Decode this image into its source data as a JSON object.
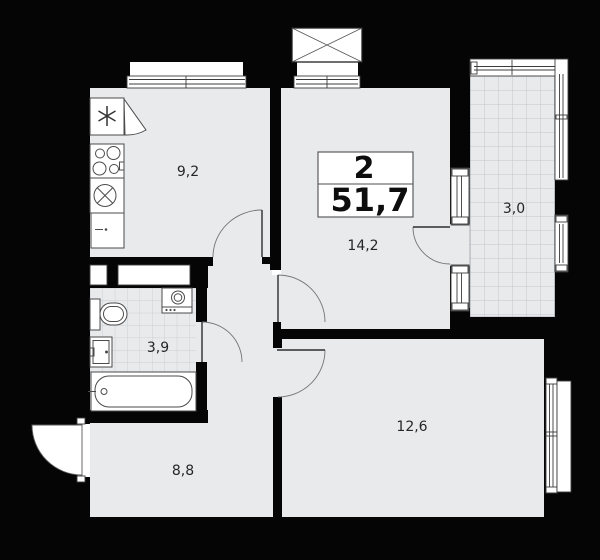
{
  "plan": {
    "type": "apartment-floor-plan",
    "summary": {
      "rooms": "2",
      "total_area": "51,7"
    },
    "rooms": {
      "kitchen": {
        "label": "9,2"
      },
      "living_room": {
        "label": "14,2"
      },
      "balcony": {
        "label": "3,0"
      },
      "bathroom": {
        "label": "3,9"
      },
      "hallway": {
        "label": "8,8"
      },
      "bedroom": {
        "label": "12,6"
      }
    },
    "fixtures": [
      "fridge",
      "stove",
      "kitchen-sink",
      "kitchen-cabinet",
      "ventilation-shaft",
      "toilet",
      "washbasin",
      "washing-machine",
      "bathtub"
    ],
    "features": [
      "entrance-door",
      "kitchen-door",
      "living-room-door",
      "bedroom-door",
      "bathroom-door",
      "balcony-door",
      "windows",
      "balcony-glazing"
    ],
    "colors": {
      "background": "#000000",
      "wall": "#050505",
      "floor": "#e8eaec",
      "outline": "#3c3c3c",
      "tile_line": "#cbd0d5",
      "balcony_grid_line": "#c3c8cd",
      "text": "#262626"
    }
  }
}
